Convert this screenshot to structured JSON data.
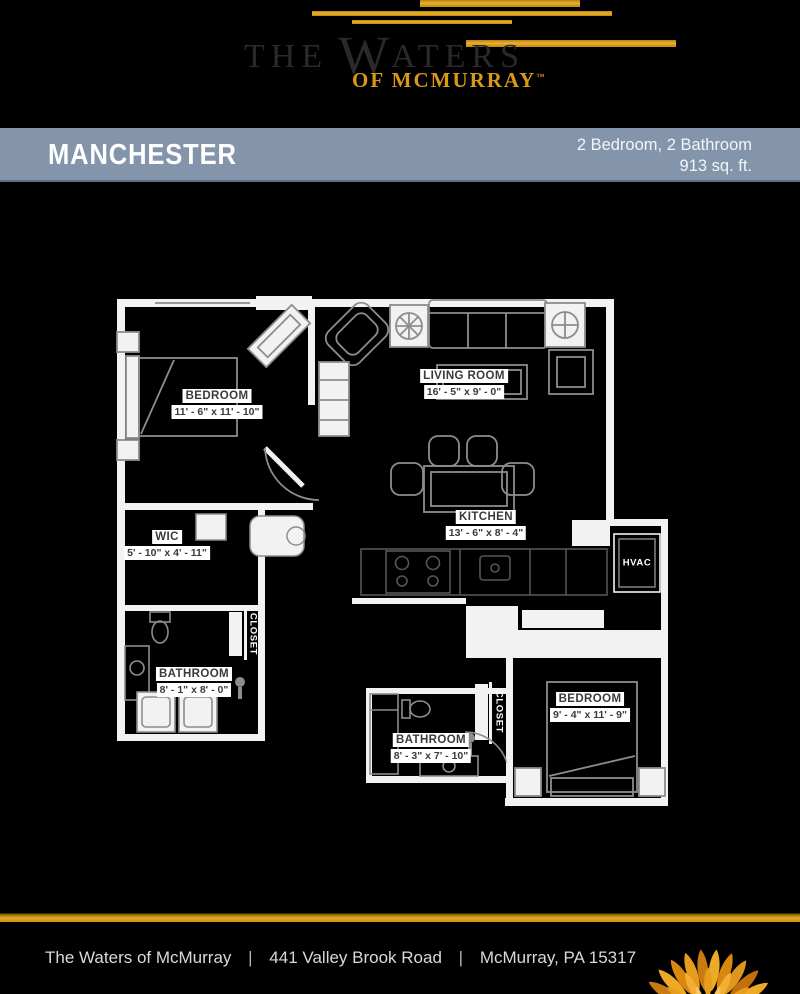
{
  "brand": {
    "name_prefix": "THE",
    "name_w": "W",
    "name_rest": "ATERS",
    "subtitle": "OF MCMURRAY",
    "trademark": "™",
    "gold_color": "#D8991A",
    "banner_color": "#8495AB"
  },
  "banner": {
    "plan_name": "MANCHESTER",
    "spec_line1": "2 Bedroom, 2 Bathroom",
    "spec_line2": "913 sq. ft."
  },
  "floorplan": {
    "bedroom1": {
      "name": "BEDROOM",
      "dims": "11' - 6\" x 11' - 10\""
    },
    "living_room": {
      "name": "LIVING ROOM",
      "dims": "16' - 5\" x 9' - 0\""
    },
    "kitchen": {
      "name": "KITCHEN",
      "dims": "13' - 6\" x 8' - 4\""
    },
    "wic": {
      "name": "WIC",
      "dims": "5' - 10\" x 4' - 11\""
    },
    "bathroom1": {
      "name": "BATHROOM",
      "dims": "8' - 1\" x 8' - 0\""
    },
    "bathroom2": {
      "name": "BATHROOM",
      "dims": "8' - 3\" x 7' - 10\""
    },
    "bedroom2": {
      "name": "BEDROOM",
      "dims": "9' - 4\" x 11' - 9\""
    },
    "hvac": "HVAC",
    "closet1": "CLOSET",
    "closet2": "CLOSET"
  },
  "footer": {
    "community": "The Waters of McMurray",
    "separator": "|",
    "street": "441 Valley Brook Road",
    "city": "McMurray, PA 15317"
  }
}
